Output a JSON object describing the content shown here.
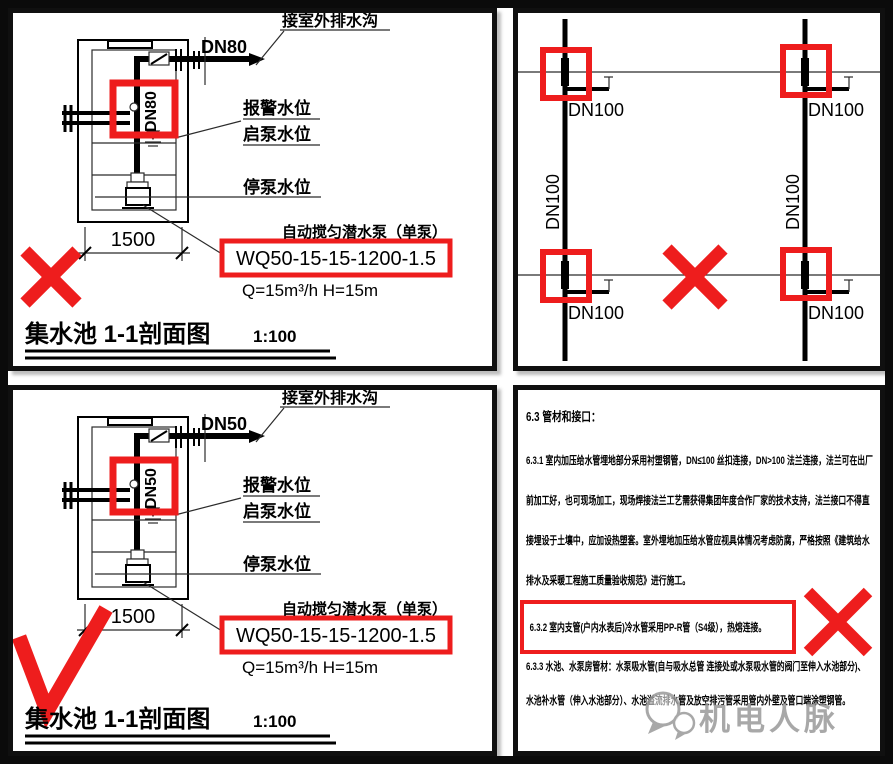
{
  "colors": {
    "highlight_red": "#ee1d1d",
    "ink": "#000000",
    "watermark_gray": "#9a9a9a"
  },
  "sections": [
    {
      "drain_label": "接室外排水沟",
      "pipe_dn": "DN80",
      "riser_dn": "DN80",
      "alarm_level": "报警水位",
      "start_level": "启泵水位",
      "stop_level": "停泵水位",
      "pump_caption": "自动搅匀潜水泵（单泵）",
      "pump_model": "WQ50-15-15-1200-1.5",
      "pump_duty": "Q=15m³/h  H=15m",
      "width_dim": "1500",
      "title": "集水池  1-1剖面图",
      "scale": "1:100"
    },
    {
      "drain_label": "接室外排水沟",
      "pipe_dn": "DN50",
      "riser_dn": "DN50",
      "alarm_level": "报警水位",
      "start_level": "启泵水位",
      "stop_level": "停泵水位",
      "pump_caption": "自动搅匀潜水泵（单泵）",
      "pump_model": "WQ50-15-15-1200-1.5",
      "pump_duty": "Q=15m³/h  H=15m",
      "width_dim": "1500",
      "title": "集水池  1-1剖面图",
      "scale": "1:100"
    }
  ],
  "plan": {
    "pipe_label": "DN100"
  },
  "notes": {
    "heading": "6.3 管材和接口：",
    "p631": [
      "6.3.1 室内加压给水管埋地部分采用衬塑钢管，DN≤100 丝扣连接，DN>100 法兰连接，法兰可在出厂",
      "前加工好，也可现场加工，现场焊接法兰工艺需获得集团年度合作厂家的技术支持，法兰接口不得直",
      "接埋设于土壤中，应加设热塑套。室外埋地加压给水管应视具体情况考虑防腐，严格按照《建筑给水",
      "排水及采暖工程施工质量验收规范》进行施工。"
    ],
    "l632": "6.3.2 室内支管(户内水表后)冷水管采用PP-R管（S4级），热熔连接。",
    "p633": [
      "6.3.3 水池、水泵房管材：水泵吸水管(自与吸水总管 连接处或水泵吸水管的阀门至伸入水池部分)、",
      "水池补水管（伸入水池部分）、水池溢流排水管及放空排污管采用管内外壁及管口端涂塑钢管。"
    ]
  },
  "watermark": {
    "text": "机电人脉"
  }
}
